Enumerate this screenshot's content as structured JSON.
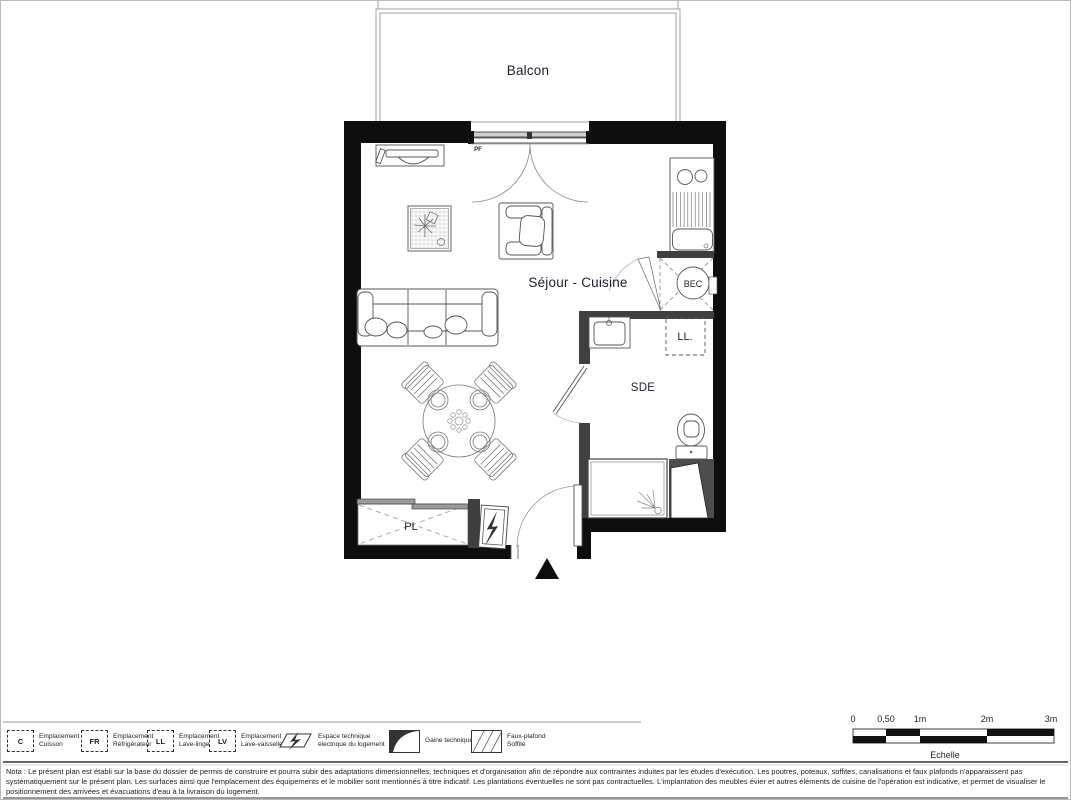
{
  "plan": {
    "balcony_label": "Balcon",
    "living_kitchen_label": "Séjour - Cuisine",
    "bathroom_label": "SDE",
    "closet_label": "PL",
    "washing_machine_label": "LL.",
    "water_heater_label": "BEC",
    "french_window_label": "PF"
  },
  "scale_bar": {
    "ticks": [
      "0",
      "0,50",
      "1m",
      "2m",
      "3m"
    ],
    "caption": "Echelle"
  },
  "legend": {
    "items": [
      {
        "symbol": "C",
        "line1": "Emplacement",
        "line2": "Cuisson"
      },
      {
        "symbol": "FR",
        "line1": "Emplacement",
        "line2": "Réfrigérateur"
      },
      {
        "symbol": "LL",
        "line1": "Emplacement",
        "line2": "Lave-linge"
      },
      {
        "symbol": "LV",
        "line1": "Emplacement",
        "line2": "Lave-vaisselle"
      },
      {
        "icon": "electrical-space-icon",
        "line1": "Espace technique",
        "line2": "électrique du logement"
      },
      {
        "icon": "technical-duct-icon",
        "line1": "Gaine technique",
        "line2": ""
      },
      {
        "icon": "false-ceiling-icon",
        "line1": "Faux-plafond",
        "line2": "Soffite"
      }
    ]
  },
  "nota": {
    "text": "Nota : Le présent plan est établi sur la base du dossier de permis de construire et pourra subir des adaptations dimensionnelles, techniques et d'organisation afin de répondre aux contraintes induites par les études d'exécution. Les poutres, poteaux, soffites, canalisations et faux plafonds n'apparaissent pas systématiquement sur le présent plan. Les surfaces ainsi que l'emplacement des équipements et le mobilier sont mentionnés à titre indicatif. Les plantations éventuelles ne sont pas contractuelles. L'implantation des meubles évier et autres éléments de cuisine de l'opération est indicative, et permet de visualiser le positionnement des arrivées et évacuations d'eau à la livraison du logement."
  },
  "colors": {
    "wall": "#0e0e0e",
    "partition": "#3f3f3f",
    "window_fill": "#cfcfcf",
    "text": "#1e1e2a"
  }
}
